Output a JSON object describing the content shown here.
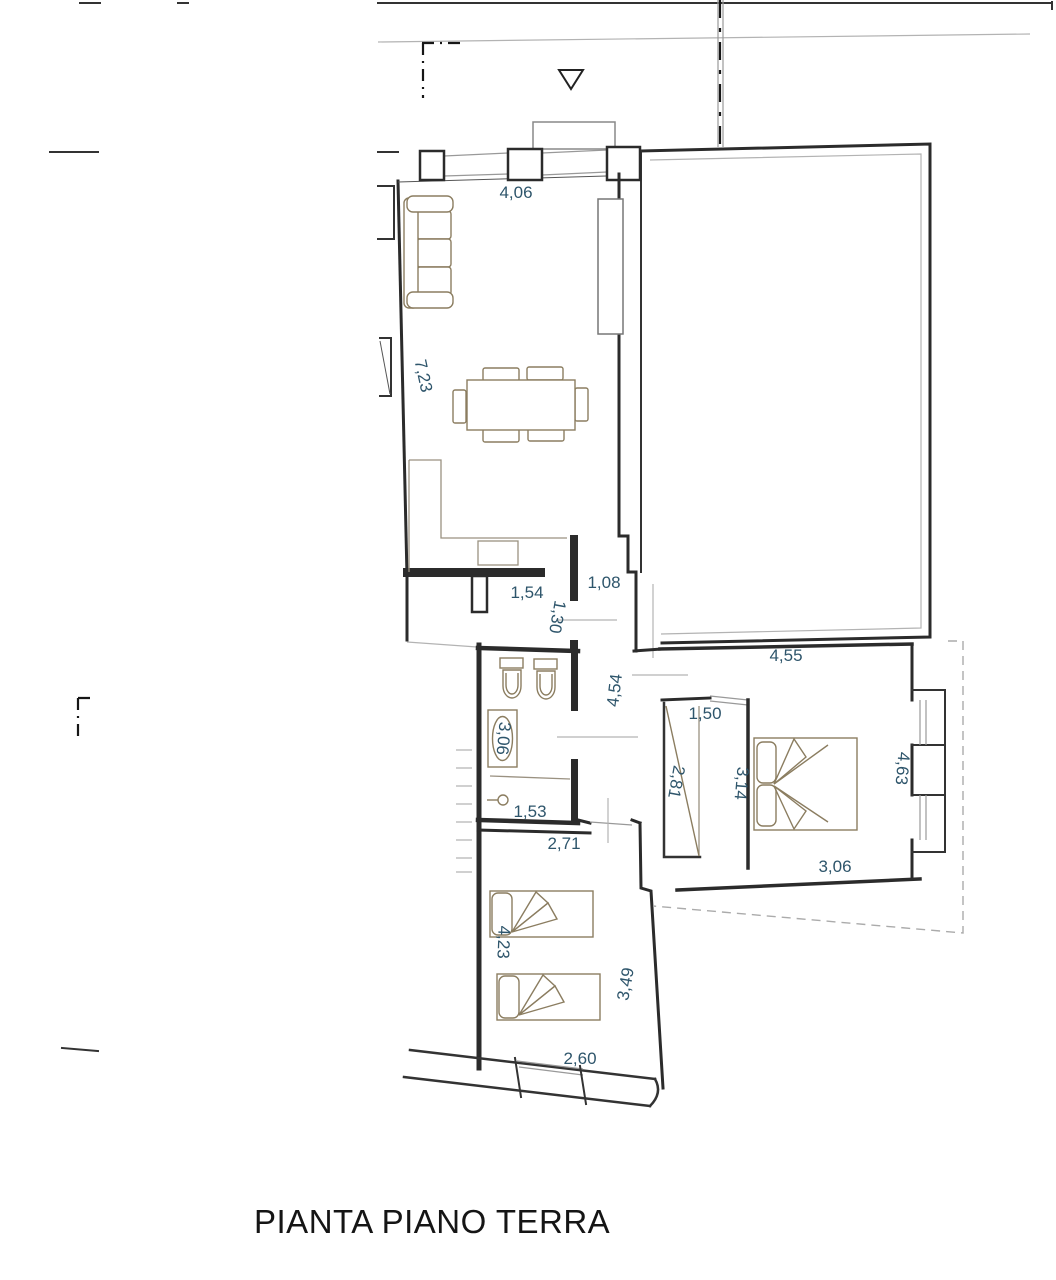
{
  "title": "PIANTA PIANO TERRA",
  "colors": {
    "dimension_text": "#2e556b",
    "wall": "#2b2b2b",
    "furniture": "#8b7d60",
    "construction": "#b3b3b3"
  },
  "dims": [
    {
      "value": "4,06"
    },
    {
      "value": "7,23"
    },
    {
      "value": "1,54"
    },
    {
      "value": "1,08"
    },
    {
      "value": "1,30"
    },
    {
      "value": "4,54"
    },
    {
      "value": "3,06"
    },
    {
      "value": "1,53"
    },
    {
      "value": "4,55"
    },
    {
      "value": "1,50"
    },
    {
      "value": "2,81"
    },
    {
      "value": "3,14"
    },
    {
      "value": "4,63"
    },
    {
      "value": "3,06"
    },
    {
      "value": "2,71"
    },
    {
      "value": "4,23"
    },
    {
      "value": "3,49"
    },
    {
      "value": "2,60"
    }
  ]
}
